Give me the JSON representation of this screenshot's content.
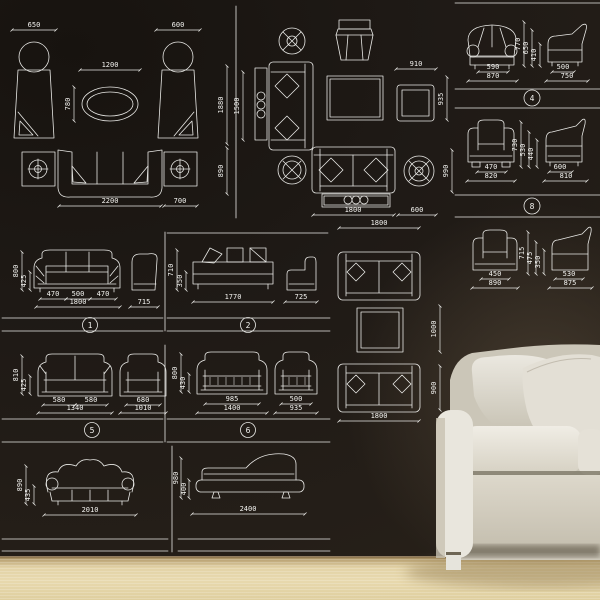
{
  "colors": {
    "line": "#e9e9e6",
    "wall": "#1f1a16",
    "floor": "#e2d2a6",
    "sofa": "#e7e4db"
  },
  "plan_a": {
    "chair_left_w": "650",
    "chair_right_w": "600",
    "table_w": "1200",
    "table_d": "780",
    "sofa_w": "2200",
    "side_table_w": "700",
    "total_d": "1880",
    "sofa_d": "890"
  },
  "plan_b": {
    "console_l": "1500",
    "chair_w": "910",
    "chair_d": "935",
    "sofa_w": "1800",
    "side_table_w": "600",
    "sofa_d": "990"
  },
  "set4": {
    "num": "4",
    "front_inner": "590",
    "front_outer": "870",
    "side_inner": "500",
    "side_outer": "750",
    "h1": "770",
    "h2": "650",
    "h3": "410"
  },
  "set8": {
    "num": "8",
    "front_inner": "470",
    "front_outer": "820",
    "side_inner": "600",
    "side_outer": "810",
    "h1": "730",
    "h2": "530",
    "h3": "440"
  },
  "set_r3": {
    "front_inner": "450",
    "front_outer": "890",
    "side_inner": "530",
    "side_outer": "875",
    "h1": "715",
    "h2": "475",
    "h3": "350"
  },
  "set1": {
    "num": "1",
    "seg1": "470",
    "seg2": "500",
    "seg3": "470",
    "total": "1800",
    "h1": "800",
    "h2": "425",
    "side": "715"
  },
  "set2": {
    "num": "2",
    "total": "1770",
    "side": "725",
    "h1": "710",
    "h2": "350"
  },
  "plan_c": {
    "sofa_top_w": "1800",
    "gap": "1000",
    "sofa_d": "900",
    "sofa_bottom_w": "1800"
  },
  "set5": {
    "num": "5",
    "seg1": "580",
    "seg2": "580",
    "total": "1340",
    "chair_inner": "680",
    "chair_total": "1010",
    "h1": "810",
    "h2": "425"
  },
  "set6": {
    "num": "6",
    "sofa_inner": "985",
    "sofa_total": "1400",
    "chair_inner": "500",
    "chair_total": "935",
    "h1": "800",
    "h2": "430"
  },
  "set7": {
    "total": "2010",
    "h1": "890",
    "h2": "435"
  },
  "set9": {
    "total": "2400",
    "h1": "980",
    "h2": "400"
  }
}
